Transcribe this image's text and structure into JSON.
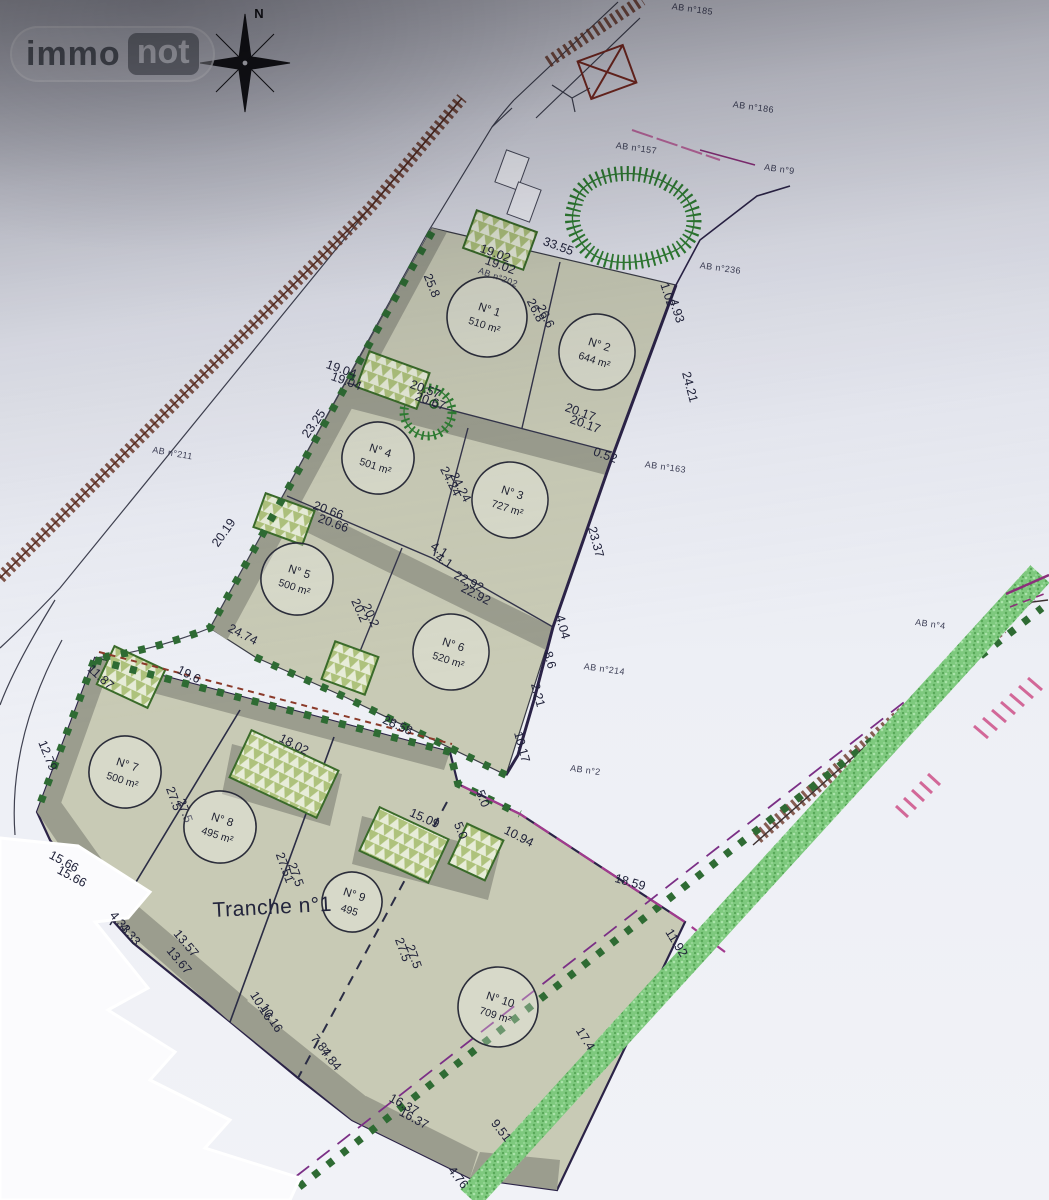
{
  "branding": {
    "logo_left": "immo",
    "logo_right": "not"
  },
  "compass": {
    "label": "N"
  },
  "colors": {
    "plot_fill": "#c8cab5",
    "setback_band": "#9b9d8e",
    "boundary_green": "#2e6b33",
    "boundary_navy": "#2b2347",
    "hedge_green": "#7ec97e",
    "fence_pink": "#c9619a",
    "hatch_brown": "#6b382a",
    "magenta_line": "#8b2f7a"
  },
  "plan": {
    "tranche_label": "Tranche n°1",
    "plots": [
      {
        "id": 1,
        "label": "N° 1",
        "area": "510 m²",
        "cx": 487,
        "cy": 317,
        "r": 40
      },
      {
        "id": 2,
        "label": "N° 2",
        "area": "644 m²",
        "cx": 597,
        "cy": 352,
        "r": 38
      },
      {
        "id": 3,
        "label": "N° 3",
        "area": "727 m²",
        "cx": 510,
        "cy": 500,
        "r": 38
      },
      {
        "id": 4,
        "label": "N° 4",
        "area": "501 m²",
        "cx": 378,
        "cy": 458,
        "r": 36
      },
      {
        "id": 5,
        "label": "N° 5",
        "area": "500 m²",
        "cx": 297,
        "cy": 579,
        "r": 36
      },
      {
        "id": 6,
        "label": "N° 6",
        "area": "520 m²",
        "cx": 451,
        "cy": 652,
        "r": 38
      },
      {
        "id": 7,
        "label": "N° 7",
        "area": "500 m²",
        "cx": 125,
        "cy": 772,
        "r": 36
      },
      {
        "id": 8,
        "label": "N° 8",
        "area": "495 m²",
        "cx": 220,
        "cy": 827,
        "r": 36
      },
      {
        "id": 9,
        "label": "N° 9",
        "area": "495",
        "cx": 352,
        "cy": 902,
        "r": 30
      },
      {
        "id": 10,
        "label": "N° 10",
        "area": "709 m²",
        "cx": 498,
        "cy": 1007,
        "r": 40
      }
    ],
    "dimensions": [
      {
        "text": "33.55",
        "x": 557,
        "y": 250,
        "rot": 20
      },
      {
        "text": "19.02",
        "x": 494,
        "y": 257,
        "rot": 20
      },
      {
        "text": "19.02",
        "x": 499,
        "y": 269,
        "rot": 20
      },
      {
        "text": "25.8",
        "x": 428,
        "y": 287,
        "rot": 68
      },
      {
        "text": "26.8",
        "x": 532,
        "y": 312,
        "rot": 63
      },
      {
        "text": "26.6",
        "x": 542,
        "y": 318,
        "rot": 63
      },
      {
        "text": "1.02",
        "x": 664,
        "y": 296,
        "rot": 72
      },
      {
        "text": "4.93",
        "x": 673,
        "y": 312,
        "rot": 72
      },
      {
        "text": "24.21",
        "x": 686,
        "y": 388,
        "rot": 75
      },
      {
        "text": "20.17",
        "x": 579,
        "y": 416,
        "rot": 20
      },
      {
        "text": "20.17",
        "x": 584,
        "y": 428,
        "rot": 20
      },
      {
        "text": "20.57",
        "x": 424,
        "y": 393,
        "rot": 20
      },
      {
        "text": "20.67",
        "x": 429,
        "y": 405,
        "rot": 20
      },
      {
        "text": "19.04",
        "x": 340,
        "y": 373,
        "rot": 20
      },
      {
        "text": "19.04",
        "x": 345,
        "y": 385,
        "rot": 20
      },
      {
        "text": "24.24",
        "x": 447,
        "y": 483,
        "rot": 63
      },
      {
        "text": "24.24",
        "x": 457,
        "y": 489,
        "rot": 63
      },
      {
        "text": "23.37",
        "x": 592,
        "y": 543,
        "rot": 75
      },
      {
        "text": "0.52",
        "x": 604,
        "y": 459,
        "rot": 20
      },
      {
        "text": "20.66",
        "x": 327,
        "y": 514,
        "rot": 20
      },
      {
        "text": "20.66",
        "x": 332,
        "y": 527,
        "rot": 20
      },
      {
        "text": "4.1",
        "x": 437,
        "y": 553,
        "rot": 33
      },
      {
        "text": "4.1",
        "x": 442,
        "y": 564,
        "rot": 33
      },
      {
        "text": "22.92",
        "x": 467,
        "y": 585,
        "rot": 27
      },
      {
        "text": "22.92",
        "x": 474,
        "y": 598,
        "rot": 27
      },
      {
        "text": "20.2",
        "x": 356,
        "y": 612,
        "rot": 66
      },
      {
        "text": "20.2",
        "x": 367,
        "y": 617,
        "rot": 66
      },
      {
        "text": "24.74",
        "x": 241,
        "y": 638,
        "rot": 27
      },
      {
        "text": "4.04",
        "x": 559,
        "y": 628,
        "rot": 75
      },
      {
        "text": "8.6",
        "x": 546,
        "y": 661,
        "rot": 75
      },
      {
        "text": "2.21",
        "x": 534,
        "y": 696,
        "rot": 75
      },
      {
        "text": "10.17",
        "x": 518,
        "y": 748,
        "rot": 75
      },
      {
        "text": "28.58",
        "x": 396,
        "y": 729,
        "rot": 24
      },
      {
        "text": "18.02",
        "x": 292,
        "y": 748,
        "rot": 27
      },
      {
        "text": "11.87",
        "x": 98,
        "y": 680,
        "rot": 42
      },
      {
        "text": "19.6",
        "x": 187,
        "y": 678,
        "rot": 27
      },
      {
        "text": "12.79",
        "x": 44,
        "y": 757,
        "rot": 68
      },
      {
        "text": "15.09",
        "x": 423,
        "y": 822,
        "rot": 24
      },
      {
        "text": "5.0",
        "x": 479,
        "y": 800,
        "rot": 68
      },
      {
        "text": "5.0",
        "x": 457,
        "y": 832,
        "rot": 68
      },
      {
        "text": "10.94",
        "x": 517,
        "y": 840,
        "rot": 27
      },
      {
        "text": "18.59",
        "x": 629,
        "y": 886,
        "rot": 16
      },
      {
        "text": "11.92",
        "x": 673,
        "y": 945,
        "rot": 58
      },
      {
        "text": "20.19",
        "x": 227,
        "y": 535,
        "rot": -55
      },
      {
        "text": "23.25",
        "x": 317,
        "y": 426,
        "rot": -55
      },
      {
        "text": "27.5",
        "x": 170,
        "y": 800,
        "rot": 70
      },
      {
        "text": "27.5",
        "x": 181,
        "y": 812,
        "rot": 70
      },
      {
        "text": "27.51",
        "x": 281,
        "y": 869,
        "rot": 70
      },
      {
        "text": "27.5",
        "x": 292,
        "y": 876,
        "rot": 70
      },
      {
        "text": "27.5",
        "x": 399,
        "y": 951,
        "rot": 70
      },
      {
        "text": "27.5",
        "x": 410,
        "y": 958,
        "rot": 70
      },
      {
        "text": "15.66",
        "x": 62,
        "y": 865,
        "rot": 28
      },
      {
        "text": "15.66",
        "x": 70,
        "y": 880,
        "rot": 28
      },
      {
        "text": "4.33",
        "x": 117,
        "y": 925,
        "rot": 50
      },
      {
        "text": "4.33",
        "x": 127,
        "y": 937,
        "rot": 50
      },
      {
        "text": "13.57",
        "x": 183,
        "y": 946,
        "rot": 50
      },
      {
        "text": "13.67",
        "x": 176,
        "y": 963,
        "rot": 50
      },
      {
        "text": "10.16",
        "x": 258,
        "y": 1008,
        "rot": 58
      },
      {
        "text": "10.16",
        "x": 268,
        "y": 1020,
        "rot": 58
      },
      {
        "text": "7.84",
        "x": 318,
        "y": 1048,
        "rot": 50
      },
      {
        "text": "7.84",
        "x": 328,
        "y": 1062,
        "rot": 50
      },
      {
        "text": "16.37",
        "x": 402,
        "y": 1108,
        "rot": 28
      },
      {
        "text": "16.37",
        "x": 412,
        "y": 1122,
        "rot": 28
      },
      {
        "text": "9.51",
        "x": 498,
        "y": 1133,
        "rot": 52
      },
      {
        "text": "4.76",
        "x": 455,
        "y": 1180,
        "rot": 52
      },
      {
        "text": "17.4",
        "x": 582,
        "y": 1041,
        "rot": 58
      }
    ],
    "parcel_refs": [
      {
        "text": "AB n°202",
        "x": 497,
        "y": 280,
        "rot": 20
      },
      {
        "text": "AB n°211",
        "x": 172,
        "y": 456,
        "rot": 10
      },
      {
        "text": "AB n°163",
        "x": 665,
        "y": 470,
        "rot": 8
      },
      {
        "text": "AB n°214",
        "x": 604,
        "y": 672,
        "rot": 8
      },
      {
        "text": "AB n°2",
        "x": 585,
        "y": 773,
        "rot": 8
      },
      {
        "text": "AB n°236",
        "x": 720,
        "y": 271,
        "rot": 8
      },
      {
        "text": "AB n°186",
        "x": 753,
        "y": 110,
        "rot": 8
      },
      {
        "text": "AB n°185",
        "x": 692,
        "y": 12,
        "rot": 8
      },
      {
        "text": "AB n°157",
        "x": 636,
        "y": 151,
        "rot": 8
      },
      {
        "text": "AB n°9",
        "x": 779,
        "y": 172,
        "rot": 8
      },
      {
        "text": "AB n°4",
        "x": 930,
        "y": 627,
        "rot": 8
      }
    ]
  }
}
